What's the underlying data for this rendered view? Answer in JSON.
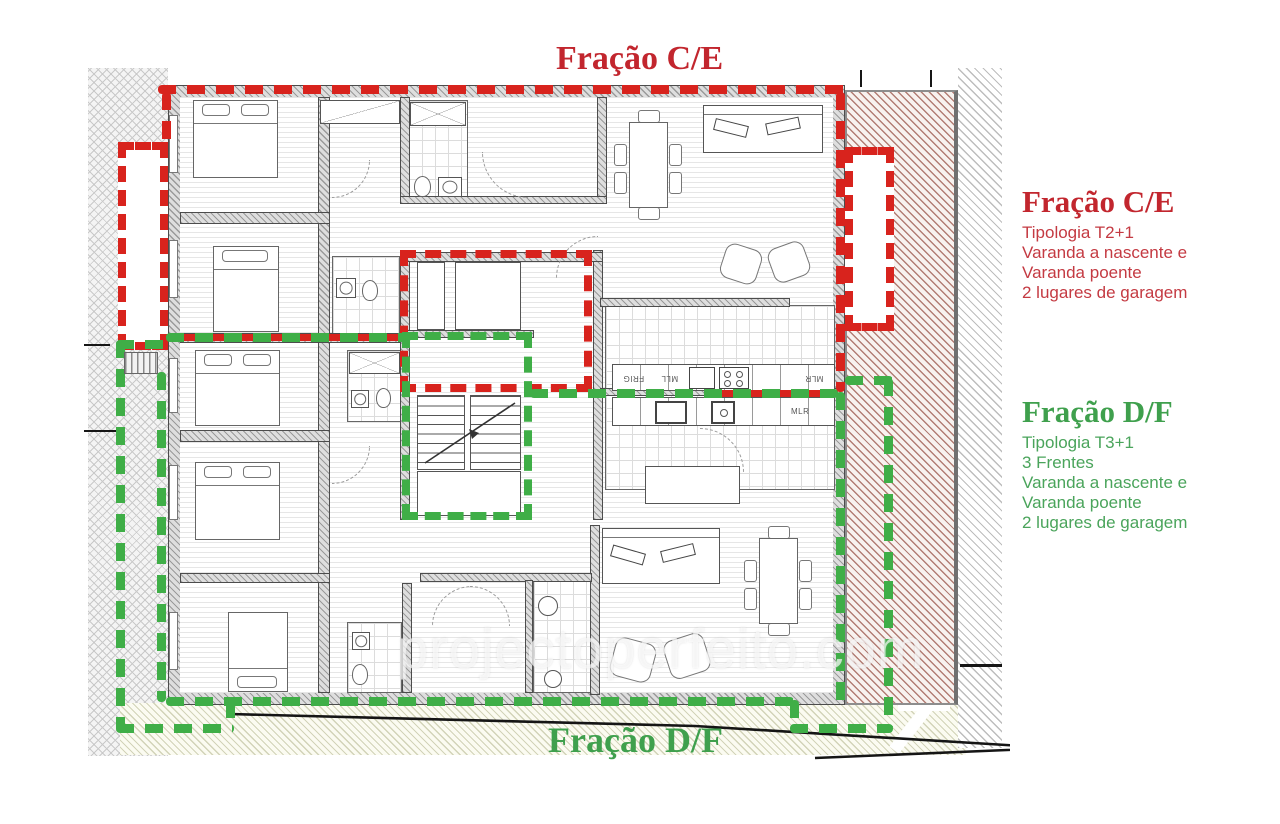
{
  "plan": {
    "top_label": "Fração C/E",
    "bottom_label": "Fração D/F",
    "watermark": "projectoperfeito.com",
    "kitchen_labels": {
      "fridge": "FRIG",
      "mll": "MLL",
      "mlr_ce": "MLR",
      "mlr_df": "MLR"
    }
  },
  "annotations": {
    "ce": {
      "title": "Fração C/E",
      "lines": [
        "Tipologia T2+1",
        "Varanda a nascente e",
        "Varanda poente",
        "2 lugares de garagem"
      ]
    },
    "df": {
      "title": "Fração D/F",
      "lines": [
        "Tipologia T3+1",
        "3 Frentes",
        "Varanda a nascente e",
        "Varanda poente",
        "2 lugares de garagem"
      ]
    }
  },
  "colors": {
    "fraction_ce_dash": "#d8231d",
    "fraction_ce_text": "#c2262e",
    "fraction_df_dash": "#3fae47",
    "fraction_df_text": "#3fa04d"
  }
}
